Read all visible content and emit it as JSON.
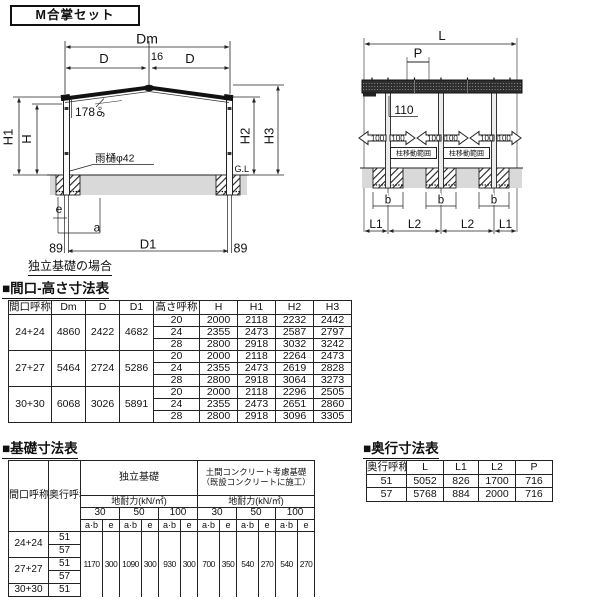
{
  "title_box": {
    "label": "M合掌セット"
  },
  "colors": {
    "ground_gray": "#d9d9d9",
    "ink": "#111111"
  },
  "front_view": {
    "dim_dm": "Dm",
    "dim_d": "D",
    "dim_gap": "16",
    "note_178": "178",
    "note_angle": "9°",
    "dim_h1": "H1",
    "dim_h": "H",
    "dim_h2": "H2",
    "dim_h3": "H3",
    "gutter_note": "雨樋φ42",
    "gl": "G.L",
    "dim_e": "e",
    "dim_a": "a",
    "dim_89": "89",
    "dim_d1": "D1",
    "caption": "独立基礎の場合"
  },
  "side_view": {
    "dim_l": "L",
    "dim_p": "P",
    "note_110": "110",
    "move_arrow": "100",
    "move_range": "柱移動範囲",
    "dim_b": "b",
    "dim_l1": "L1",
    "dim_l2": "L2"
  },
  "size_table": {
    "heading": "■間口-高さ寸法表",
    "col_headers": [
      "間口呼称",
      "Dm",
      "D",
      "D1",
      "高さ呼称",
      "H",
      "H1",
      "H2",
      "H3"
    ],
    "groups": [
      {
        "name": "24+24",
        "dm": "4860",
        "d": "2422",
        "d1": "4682",
        "heights": [
          [
            "20",
            "2000",
            "2118",
            "2232",
            "2442"
          ],
          [
            "24",
            "2355",
            "2473",
            "2587",
            "2797"
          ],
          [
            "28",
            "2800",
            "2918",
            "3032",
            "3242"
          ]
        ]
      },
      {
        "name": "27+27",
        "dm": "5464",
        "d": "2724",
        "d1": "5286",
        "heights": [
          [
            "20",
            "2000",
            "2118",
            "2264",
            "2473"
          ],
          [
            "24",
            "2355",
            "2473",
            "2619",
            "2828"
          ],
          [
            "28",
            "2800",
            "2918",
            "3064",
            "3273"
          ]
        ]
      },
      {
        "name": "30+30",
        "dm": "6068",
        "d": "3026",
        "d1": "5891",
        "heights": [
          [
            "20",
            "2000",
            "2118",
            "2296",
            "2505"
          ],
          [
            "24",
            "2355",
            "2473",
            "2651",
            "2860"
          ],
          [
            "28",
            "2800",
            "2918",
            "3096",
            "3305"
          ]
        ]
      }
    ]
  },
  "foundation_table": {
    "heading": "■基礎寸法表",
    "headers": {
      "col1": "間口呼称",
      "col2": "奥行呼称",
      "group1": "独立基礎",
      "group2": "土間コンクリート考慮基礎\n（既設コンクリートに施工）",
      "subheader": "地耐力(kN/㎡)",
      "loads": [
        "30",
        "50",
        "100"
      ],
      "leaf": [
        "a·b",
        "e"
      ]
    },
    "rows": [
      {
        "span": "24+24",
        "depths": [
          "51",
          "57"
        ]
      },
      {
        "span": "27+27",
        "depths": [
          "51",
          "57"
        ]
      },
      {
        "span": "30+30",
        "depths": [
          "51"
        ]
      }
    ],
    "values": [
      "1170",
      "300",
      "1090",
      "300",
      "930",
      "300",
      "700",
      "350",
      "540",
      "270",
      "540",
      "270"
    ]
  },
  "depth_table": {
    "heading": "■奥行寸法表",
    "col_headers": [
      "奥行呼称",
      "L",
      "L1",
      "L2",
      "P"
    ],
    "rows": [
      [
        "51",
        "5052",
        "826",
        "1700",
        "716"
      ],
      [
        "57",
        "5768",
        "884",
        "2000",
        "716"
      ]
    ]
  }
}
